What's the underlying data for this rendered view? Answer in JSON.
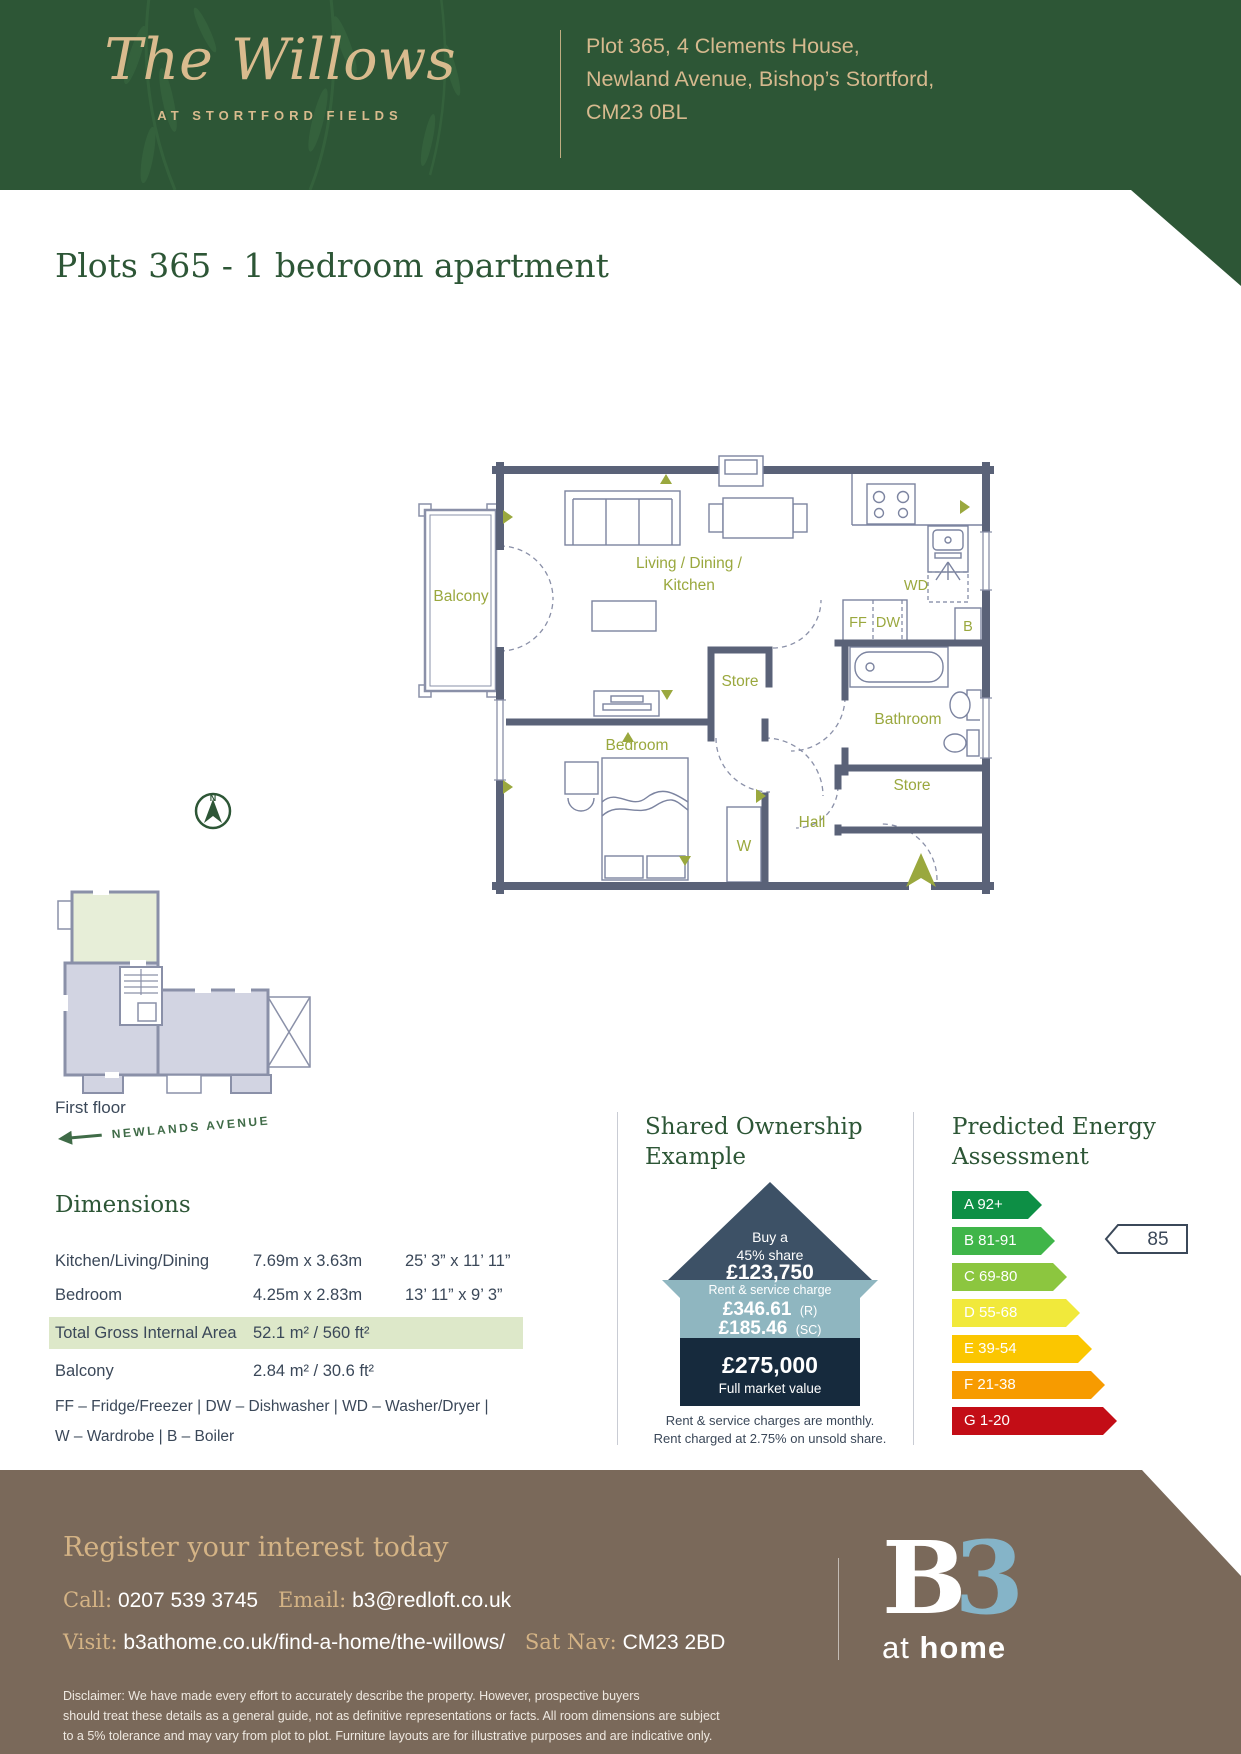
{
  "header": {
    "development_name": "The Willows",
    "tagline": "AT STORTFORD FIELDS",
    "address_line1": "Plot 365, 4 Clements House,",
    "address_line2": "Newland Avenue, Bishop’s Stortford,",
    "address_line3": "CM23 0BL"
  },
  "page_title": "Plots 365 - 1 bedroom apartment",
  "floor_plan": {
    "labels": {
      "balcony": "Balcony",
      "living_line1": "Living / Dining /",
      "living_line2": "Kitchen",
      "store_center": "Store",
      "bathroom": "Bathroom",
      "bedroom": "Bedroom",
      "store_right": "Store",
      "hall": "Hall",
      "wardrobe": "W",
      "washer_dryer": "WD",
      "fridge_freezer": "FF",
      "dishwasher": "DW",
      "boiler": "B"
    }
  },
  "locator": {
    "floor_label": "First floor",
    "street_label": "NEWLANDS AVENUE",
    "compass_label": "N"
  },
  "dimensions": {
    "heading": "Dimensions",
    "rows": [
      {
        "room": "Kitchen/Living/Dining",
        "metric": "7.69m x 3.63m",
        "imperial": "25’ 3” x 11’ 11”"
      },
      {
        "room": "Bedroom",
        "metric": "4.25m x 2.83m",
        "imperial": "13’ 11” x 9’ 3”"
      }
    ],
    "total_row": {
      "room": "Total Gross Internal Area",
      "value": "52.1 m² / 560 ft²"
    },
    "balcony_row": {
      "room": "Balcony",
      "value": "2.84 m² / 30.6 ft²"
    },
    "legend_line1": "FF – Fridge/Freezer | DW – Dishwasher | WD – Washer/Dryer |",
    "legend_line2": "W – Wardrobe | B – Boiler"
  },
  "shared_ownership": {
    "heading_line1": "Shared Ownership",
    "heading_line2": "Example",
    "roof_line1": "Buy a",
    "roof_line2": "45% share",
    "roof_value": "£123,750",
    "band_label": "Rent & service charge",
    "rent_value": "£346.61",
    "rent_suffix": "(R)",
    "sc_value": "£185.46",
    "sc_suffix": "(SC)",
    "base_value": "£275,000",
    "base_label": "Full market value",
    "note_line1": "Rent & service charges are monthly.",
    "note_line2": "Rent charged at 2.75% on unsold share."
  },
  "energy": {
    "heading_line1": "Predicted Energy",
    "heading_line2": "Assessment",
    "rating_value": "85",
    "bands": [
      {
        "label": "A 92+",
        "color": "#0d8f45"
      },
      {
        "label": "B 81-91",
        "color": "#3fb549"
      },
      {
        "label": "C 69-80",
        "color": "#8cc63f"
      },
      {
        "label": "D 55-68",
        "color": "#f1e93b"
      },
      {
        "label": "E 39-54",
        "color": "#fbc600"
      },
      {
        "label": "F 21-38",
        "color": "#f79b00"
      },
      {
        "label": "G 1-20",
        "color": "#c30d16"
      }
    ]
  },
  "footer": {
    "heading": "Register your interest today",
    "call_label": "Call:",
    "phone": "0207 539 3745",
    "email_label": "Email:",
    "email": "b3@redloft.co.uk",
    "visit_label": "Visit:",
    "website": "b3athome.co.uk/find-a-home/the-willows/",
    "satnav_label": "Sat Nav:",
    "satnav": "CM23 2BD",
    "disclaimer_line1": "Disclaimer: We have made every effort to accurately describe the property. However, prospective buyers",
    "disclaimer_line2": "should treat these details as a general guide, not as definitive representations or facts. All room dimensions are subject",
    "disclaimer_line3": "to a 5% tolerance and may vary from plot to plot. Furniture layouts are for illustrative purposes and are indicative only.",
    "logo_b": "B",
    "logo_3": "3",
    "logo_at": "at",
    "logo_home": "home"
  },
  "colors": {
    "header_green": "#2d5636",
    "brand_gold": "#d9bb8e",
    "wall_slate": "#5a6278",
    "label_olive": "#9aa83e",
    "highlight_row": "#dde8c9",
    "house_roof": "#3d5166",
    "house_band": "#8fb6c0",
    "house_base": "#162a3d",
    "footer_brown": "#7a695a",
    "logo_blue": "#85b4c8"
  }
}
